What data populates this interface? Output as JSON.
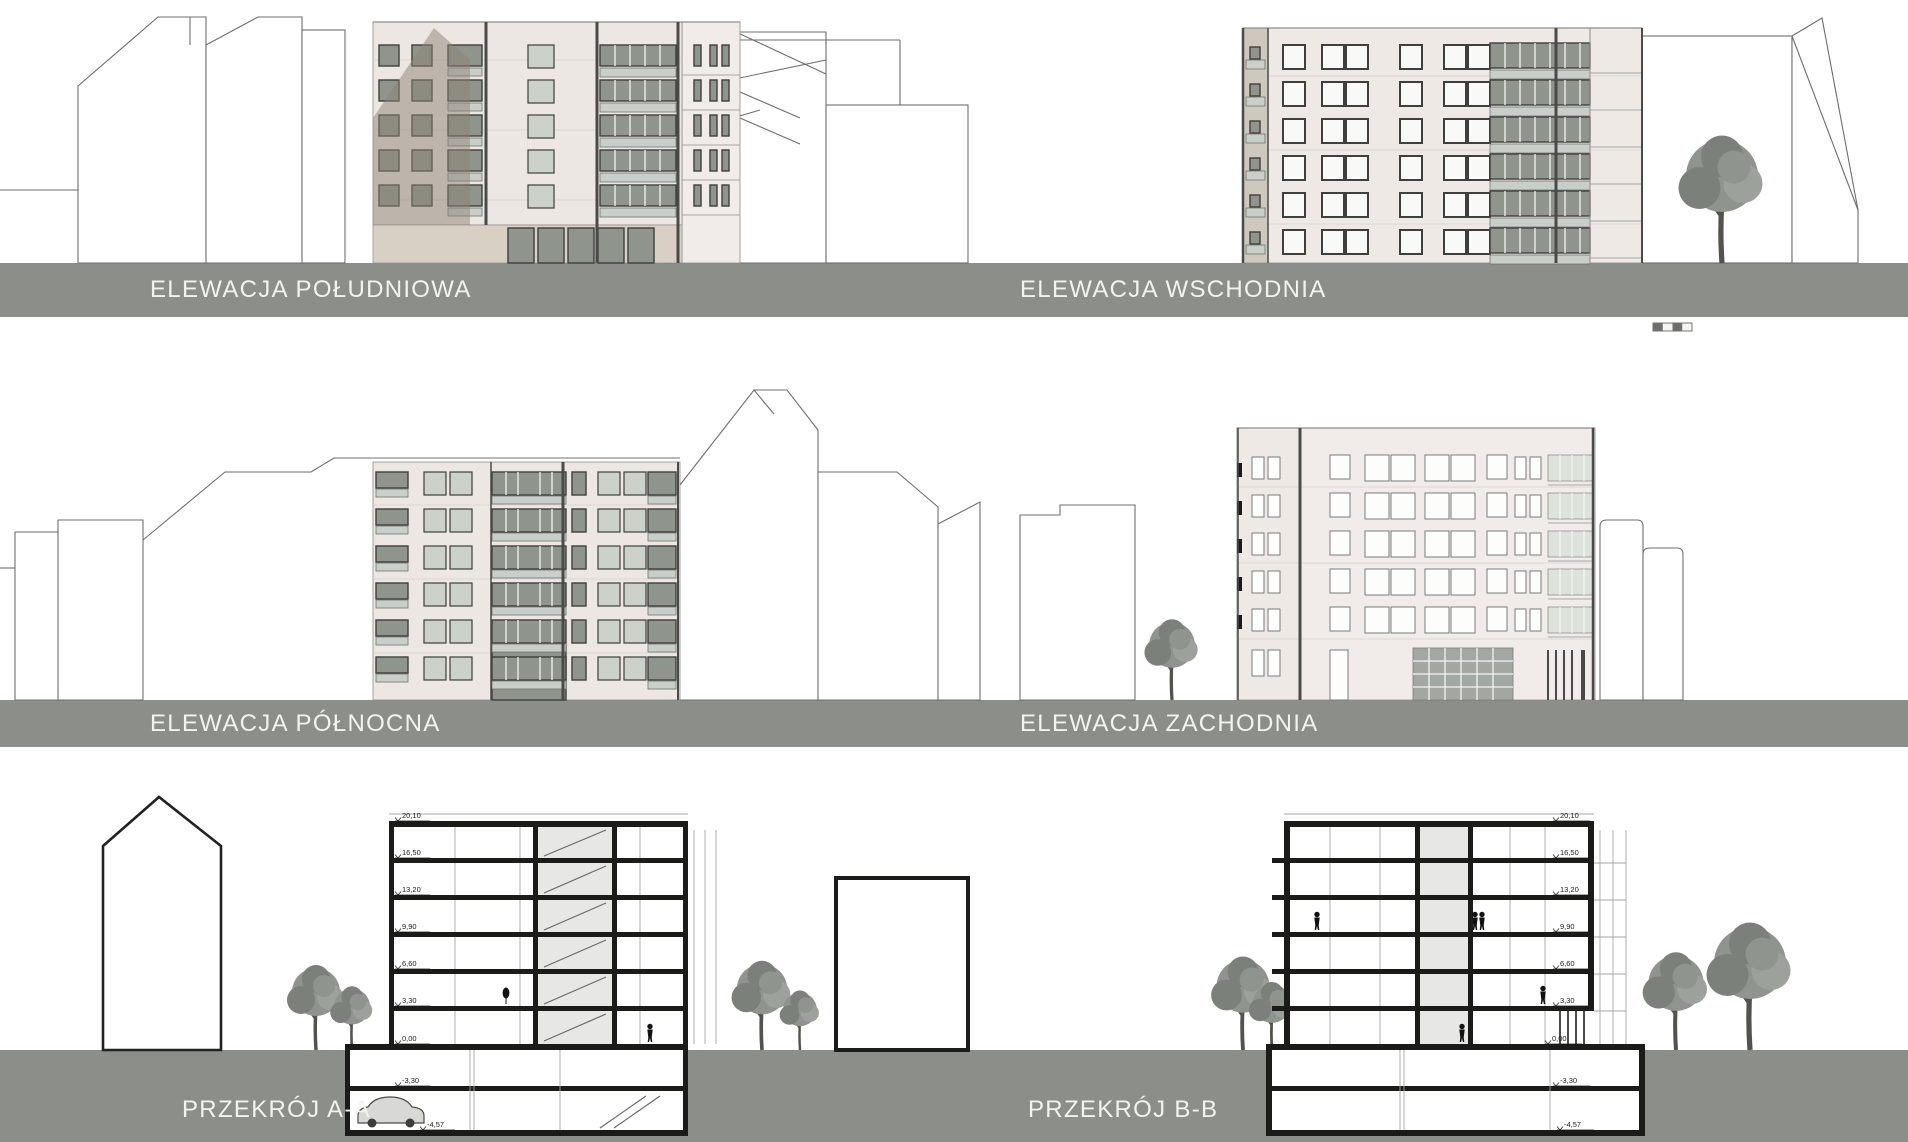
{
  "sheet": {
    "type": "architectural elevations and sections board"
  },
  "panels": {
    "south": {
      "label": "ELEWACJA POŁUDNIOWA"
    },
    "east": {
      "label": "ELEWACJA WSCHODNIA"
    },
    "north": {
      "label": "ELEWACJA PÓŁNOCNA"
    },
    "west": {
      "label": "ELEWACJA ZACHODNIA"
    },
    "section_a": {
      "label": "PRZEKRÓJ A-A"
    },
    "section_b": {
      "label": "PRZEKRÓJ B-B"
    }
  },
  "sections": {
    "levels": [
      "20,10",
      "16,50",
      "13,20",
      "9,90",
      "6,60",
      "3,30",
      "0,00",
      "-3,30",
      "-4,57"
    ]
  },
  "icons": {
    "scale_bar": "graphic-scale-bar",
    "tree": "deciduous-tree",
    "person": "human-figure-silhouette",
    "car": "car-silhouette"
  },
  "colors": {
    "band": "#8b8e89",
    "label": "#f2f3ef",
    "facade_cream": "#ece7e2",
    "facade_pink": "#efe9e5",
    "facade_shadow": "#8d8175",
    "plinth": "#d8cfc5",
    "glass_dark": "#8f948c",
    "glass_pale": "#ccd2c9",
    "window_frame": "#3f3f3d",
    "balcony_glass": "#c9cfc8",
    "post_dark": "#4a4a48",
    "outline": "#6e6e6c",
    "tree_canopy": "#8f948e",
    "tree_trunk": "#54524e",
    "section_ink": "#1b1b1a"
  }
}
